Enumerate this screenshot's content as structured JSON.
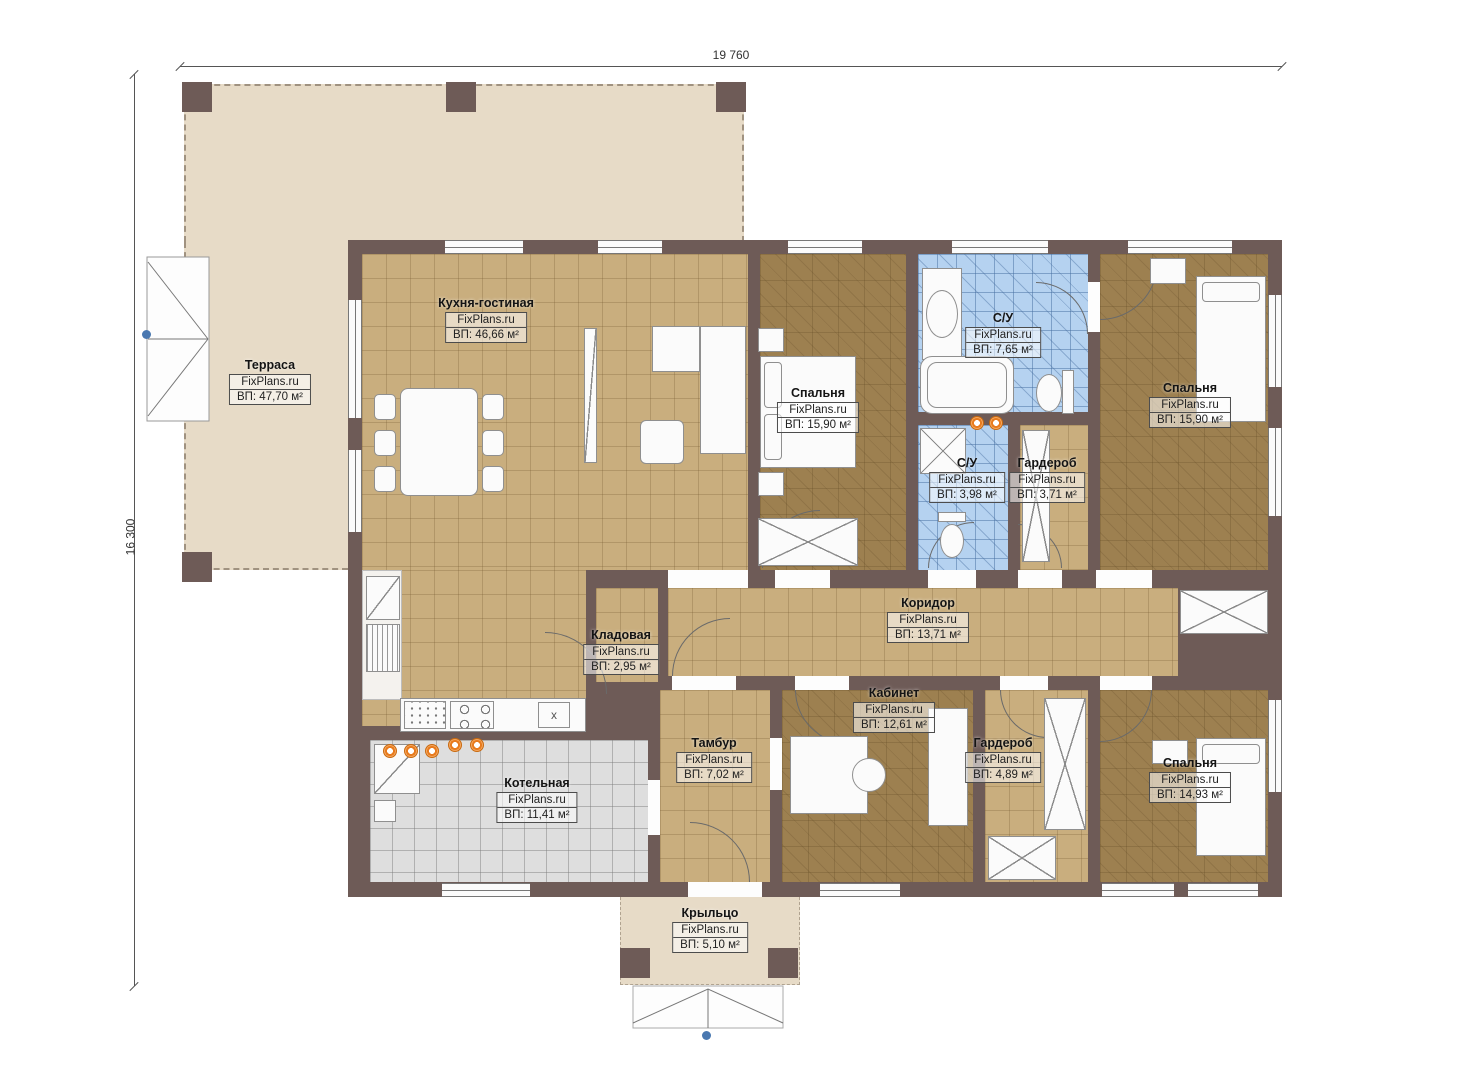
{
  "plan": {
    "brand": "FixPlans.ru",
    "dimension_width": "19 760",
    "dimension_height": "16 300",
    "sink_mark": "x",
    "colors": {
      "wall": "#6e5b57",
      "terrace_floor": "#e7dbc7",
      "tile_tan": "#c9ae7e",
      "tile_brown": "#9d8050",
      "tile_blue": "#b5d2f0",
      "tile_gray": "#dedede",
      "radiator_accent": "#e87b1e"
    },
    "rooms": [
      {
        "name": "Терраса",
        "area": "ВП: 47,70 м²"
      },
      {
        "name": "Кухня-гостиная",
        "area": "ВП: 46,66 м²"
      },
      {
        "name": "Спальня",
        "area": "ВП: 15,90 м²"
      },
      {
        "name": "С/У",
        "area": "ВП: 7,65 м²"
      },
      {
        "name": "Спальня",
        "area": "ВП: 15,90 м²"
      },
      {
        "name": "С/У",
        "area": "ВП: 3,98 м²"
      },
      {
        "name": "Гардероб",
        "area": "ВП: 3,71 м²"
      },
      {
        "name": "Коридор",
        "area": "ВП: 13,71 м²"
      },
      {
        "name": "Кладовая",
        "area": "ВП: 2,95 м²"
      },
      {
        "name": "Кабинет",
        "area": "ВП: 12,61 м²"
      },
      {
        "name": "Тамбур",
        "area": "ВП: 7,02 м²"
      },
      {
        "name": "Гардероб",
        "area": "ВП: 4,89 м²"
      },
      {
        "name": "Спальня",
        "area": "ВП: 14,93 м²"
      },
      {
        "name": "Котельная",
        "area": "ВП: 11,41 м²"
      },
      {
        "name": "Крыльцо",
        "area": "ВП: 5,10 м²"
      }
    ]
  }
}
